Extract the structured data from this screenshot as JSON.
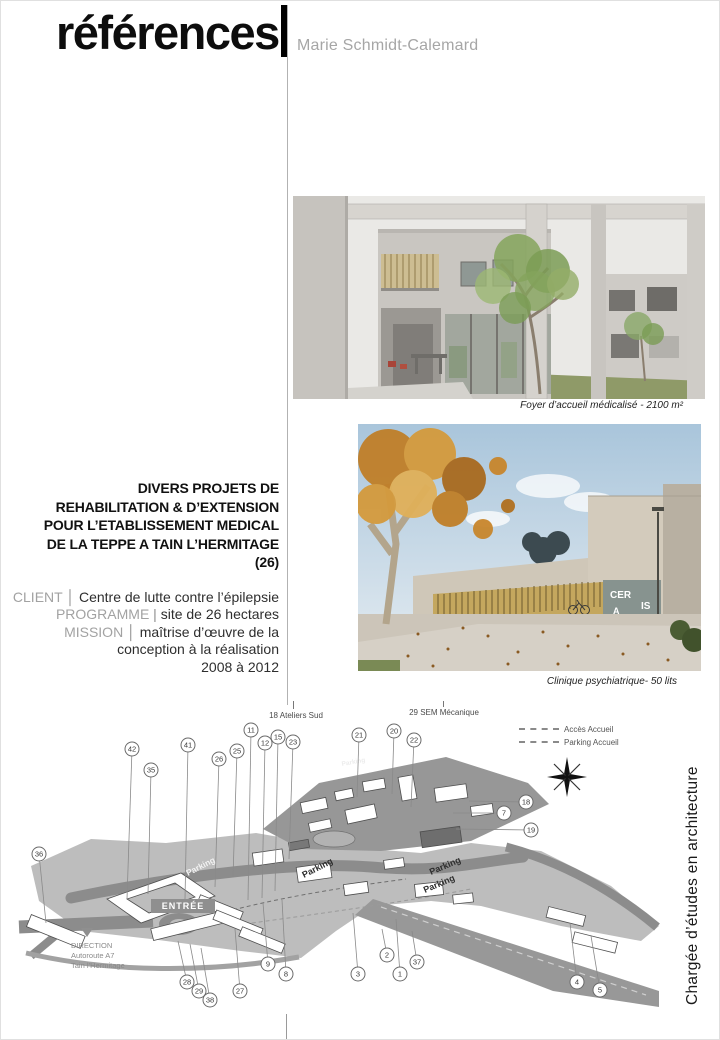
{
  "header": {
    "title": "références",
    "author": "Marie Schmidt-Calemard"
  },
  "photos": [
    {
      "name": "foyer",
      "caption": "Foyer d’accueil médicalisé - 2100 m²"
    },
    {
      "name": "clinique",
      "caption": "Clinique psychiatrique- 50 lits",
      "signage": [
        "CER",
        "IS",
        "A"
      ]
    }
  ],
  "project": {
    "title_lines": [
      "DIVERS PROJETS DE",
      "REHABILITATION & D’EXTENSION",
      "POUR L’ETABLISSEMENT MEDICAL",
      "DE LA TEPPE A TAIN L’HERMITAGE",
      "(26)"
    ],
    "meta": [
      {
        "label": "CLIENT",
        "divider": "│",
        "value": "Centre de lutte contre l’épilepsie"
      },
      {
        "label": "PROGRAMME",
        "divider": "|",
        "value": "site de 26 hectares"
      },
      {
        "label": "MISSION",
        "divider": "│",
        "value": "maîtrise d’œuvre de la conception à la réalisation"
      }
    ],
    "period": "2008 à 2012"
  },
  "map": {
    "top_labels": {
      "ateliers": "18 Ateliers Sud",
      "sem": "29 SEM Mécanique"
    },
    "legend": [
      {
        "label": "Accès Accueil"
      },
      {
        "label": "Parking Accueil"
      }
    ],
    "entrance_label": "ENTRÉE",
    "direction_lines": [
      "DIRECTION",
      "Autoroute A7",
      "Tain l’Hermitage"
    ],
    "parking_labels": [
      {
        "text": "Parking",
        "x": 187,
        "y": 875,
        "rot": -27,
        "size": 8.5,
        "fill": "#f2f2f2"
      },
      {
        "text": "Parking",
        "x": 303,
        "y": 877,
        "rot": -27,
        "size": 9,
        "fill": "#2e2e2e"
      },
      {
        "text": "Parking",
        "x": 430,
        "y": 874,
        "rot": -23,
        "size": 9,
        "fill": "#2e2e2e"
      },
      {
        "text": "Parking",
        "x": 424,
        "y": 892,
        "rot": -23,
        "size": 9,
        "fill": "#2e2e2e"
      },
      {
        "text": "Parking",
        "x": 341,
        "y": 765,
        "rot": -10,
        "size": 6.5,
        "fill": "#ececec"
      }
    ],
    "callouts": [
      {
        "n": "42",
        "x": 131,
        "y": 748,
        "tx": 126,
        "ty": 898
      },
      {
        "n": "35",
        "x": 150,
        "y": 769,
        "tx": 147,
        "ty": 893
      },
      {
        "n": "41",
        "x": 187,
        "y": 744,
        "tx": 184,
        "ty": 898
      },
      {
        "n": "26",
        "x": 218,
        "y": 758,
        "tx": 214,
        "ty": 886
      },
      {
        "n": "25",
        "x": 236,
        "y": 750,
        "tx": 232,
        "ty": 876
      },
      {
        "n": "11",
        "x": 250,
        "y": 729,
        "tx": 247,
        "ty": 899
      },
      {
        "n": "12",
        "x": 264,
        "y": 742,
        "tx": 261,
        "ty": 897
      },
      {
        "n": "15",
        "x": 277,
        "y": 736,
        "tx": 274,
        "ty": 890
      },
      {
        "n": "23",
        "x": 292,
        "y": 741,
        "tx": 288,
        "ty": 858
      },
      {
        "n": "21",
        "x": 358,
        "y": 734,
        "tx": 356,
        "ty": 796
      },
      {
        "n": "20",
        "x": 393,
        "y": 730,
        "tx": 391,
        "ty": 793
      },
      {
        "n": "22",
        "x": 413,
        "y": 739,
        "tx": 410,
        "ty": 806
      },
      {
        "n": "18",
        "x": 525,
        "y": 801,
        "tx": 468,
        "ty": 800
      },
      {
        "n": "7",
        "x": 503,
        "y": 812,
        "tx": 452,
        "ty": 812
      },
      {
        "n": "19",
        "x": 530,
        "y": 829,
        "tx": 455,
        "ty": 828
      },
      {
        "n": "36",
        "x": 38,
        "y": 853,
        "tx": 45,
        "ty": 922
      },
      {
        "n": "28",
        "x": 186,
        "y": 981,
        "tx": 177,
        "ty": 940
      },
      {
        "n": "29",
        "x": 198,
        "y": 990,
        "tx": 189,
        "ty": 943
      },
      {
        "n": "38",
        "x": 209,
        "y": 999,
        "tx": 200,
        "ty": 947
      },
      {
        "n": "27",
        "x": 239,
        "y": 990,
        "tx": 234,
        "ty": 928
      },
      {
        "n": "9",
        "x": 267,
        "y": 963,
        "tx": 262,
        "ty": 902
      },
      {
        "n": "8",
        "x": 285,
        "y": 973,
        "tx": 281,
        "ty": 899
      },
      {
        "n": "3",
        "x": 357,
        "y": 973,
        "tx": 352,
        "ty": 912
      },
      {
        "n": "2",
        "x": 386,
        "y": 954,
        "tx": 381,
        "ty": 928
      },
      {
        "n": "1",
        "x": 399,
        "y": 973,
        "tx": 395,
        "ty": 918
      },
      {
        "n": "37",
        "x": 416,
        "y": 961,
        "tx": 411,
        "ty": 930
      },
      {
        "n": "4",
        "x": 576,
        "y": 981,
        "tx": 569,
        "ty": 922
      },
      {
        "n": "5",
        "x": 599,
        "y": 989,
        "tx": 590,
        "ty": 935
      }
    ]
  },
  "sidebar_vertical_text": "Chargée d’études en architecture",
  "colors": {
    "divider": "#b2b2b2",
    "muted_text": "#a6a6a6",
    "map_terrain": "#bdbdbd",
    "autumn_accent": "#c8862c",
    "lawn_accent": "#8f9a68"
  }
}
